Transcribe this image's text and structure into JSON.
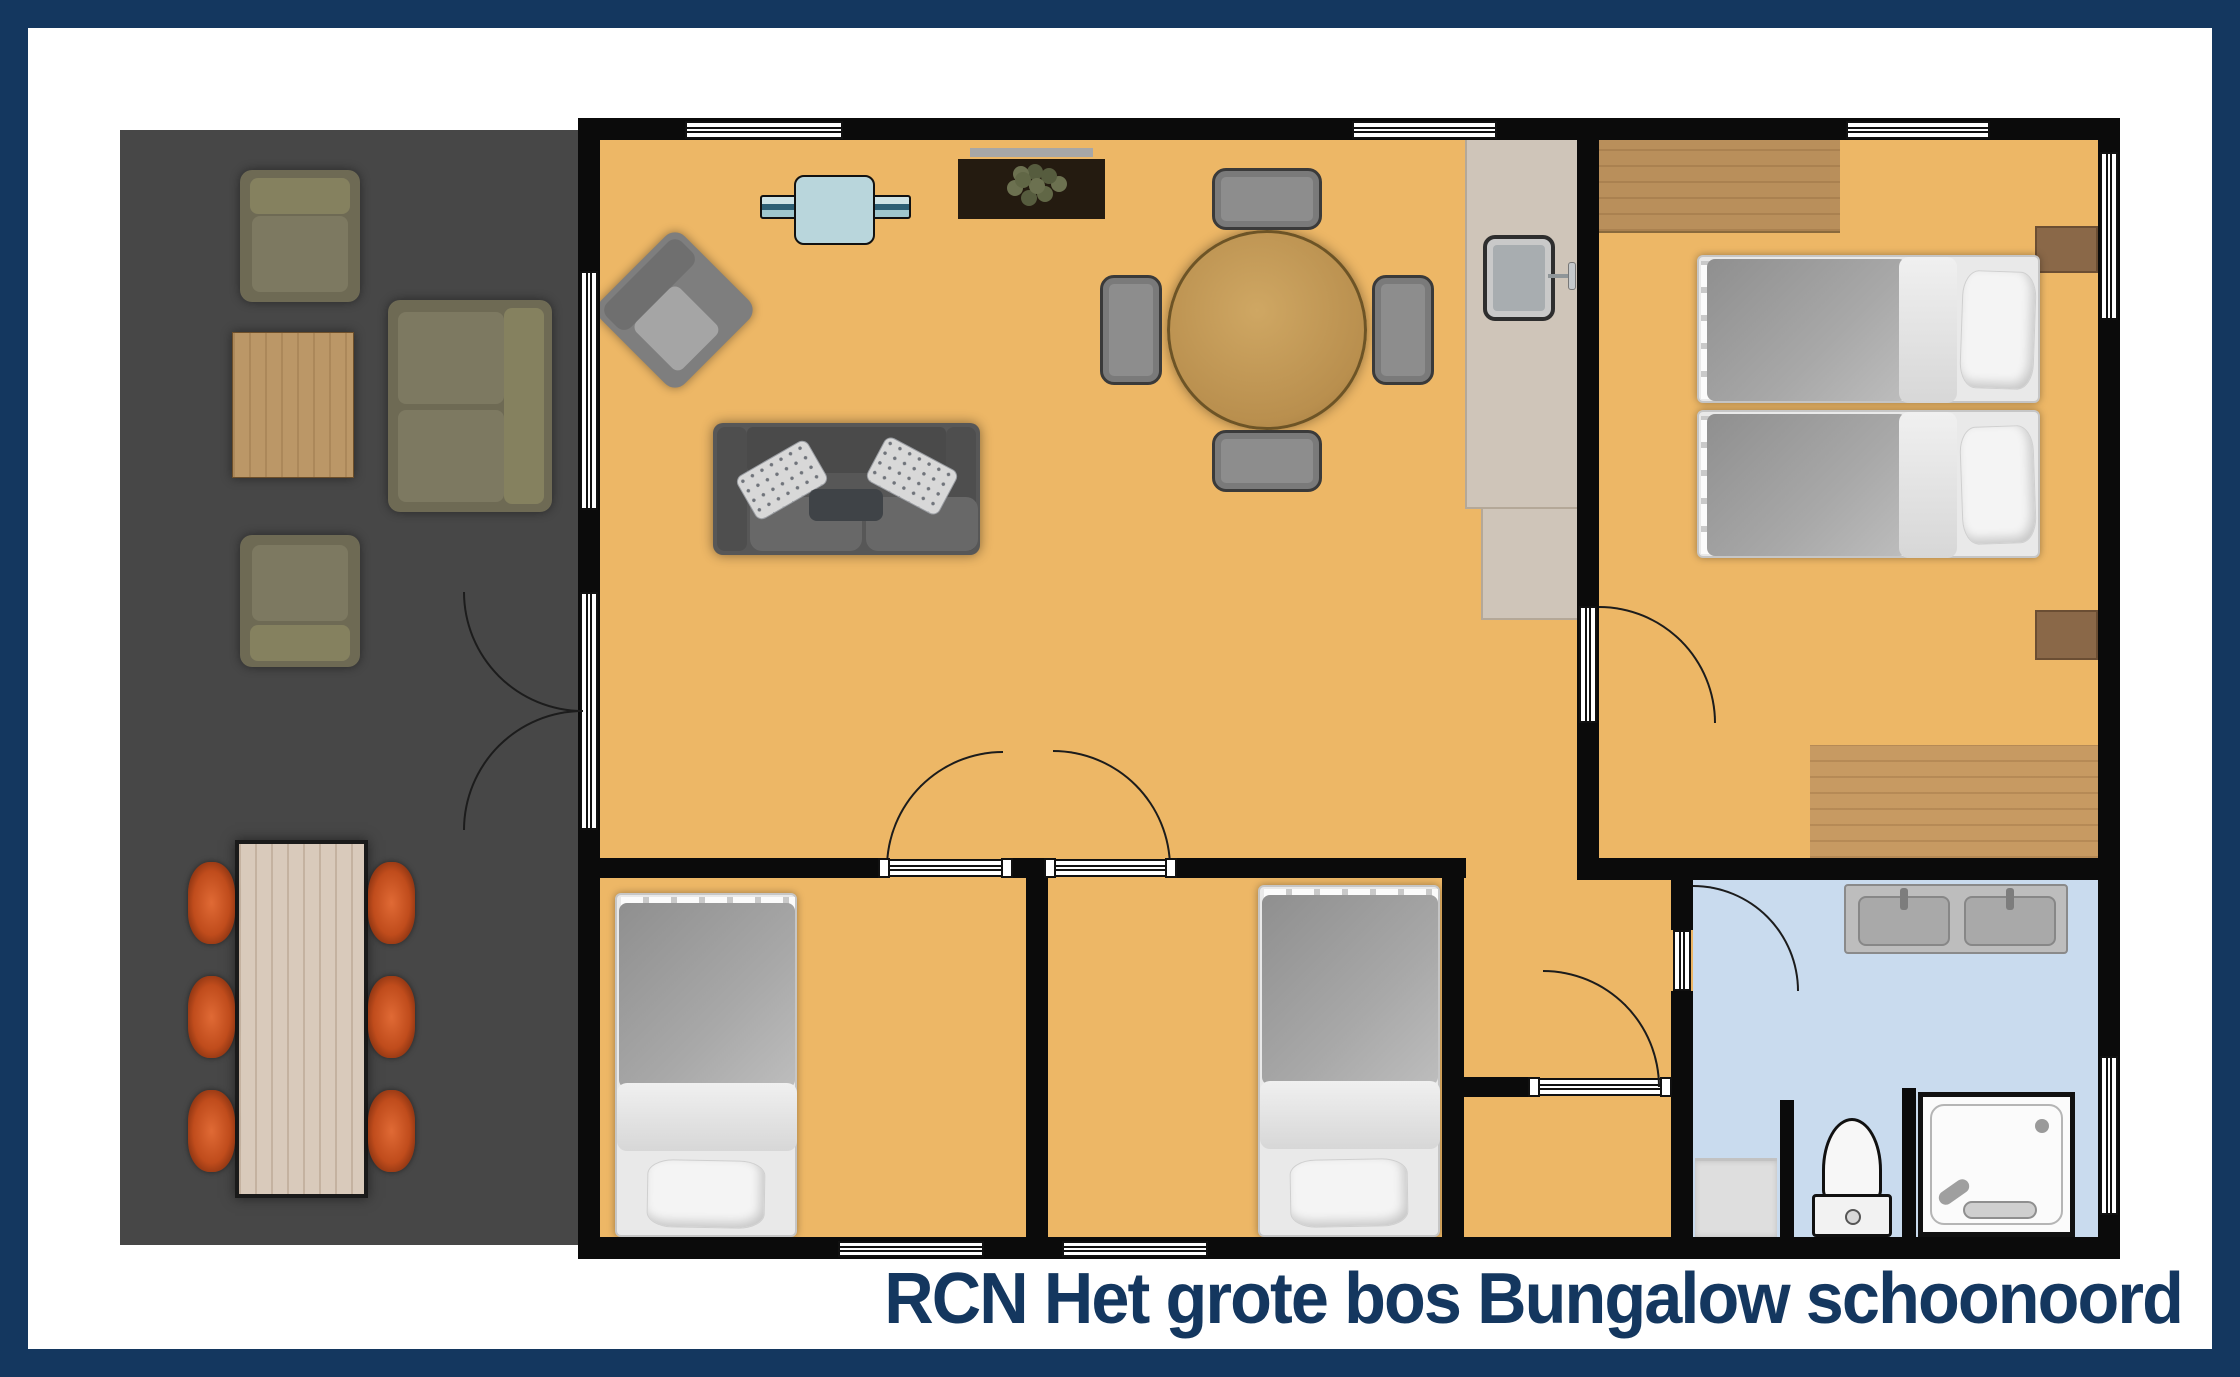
{
  "title": "RCN Het grote bos Bungalow schoonoord",
  "colors": {
    "navy": "#14375f",
    "floor": "#edb766",
    "terrace": "#474747",
    "wall": "#0b0b0b",
    "bath": "#c9dbee",
    "counter": "#cfc5b9",
    "woodlight": "#c79a62",
    "woodpale": "#d9cabb",
    "woodmid": "#b98f5b",
    "olive": "#6e6a54",
    "olivecushion": "#7d7961",
    "sofagray": "#575757",
    "chairgray": "#8d8d8d",
    "tvblue": "#b9d6dc",
    "orange": "#c94f1d"
  }
}
